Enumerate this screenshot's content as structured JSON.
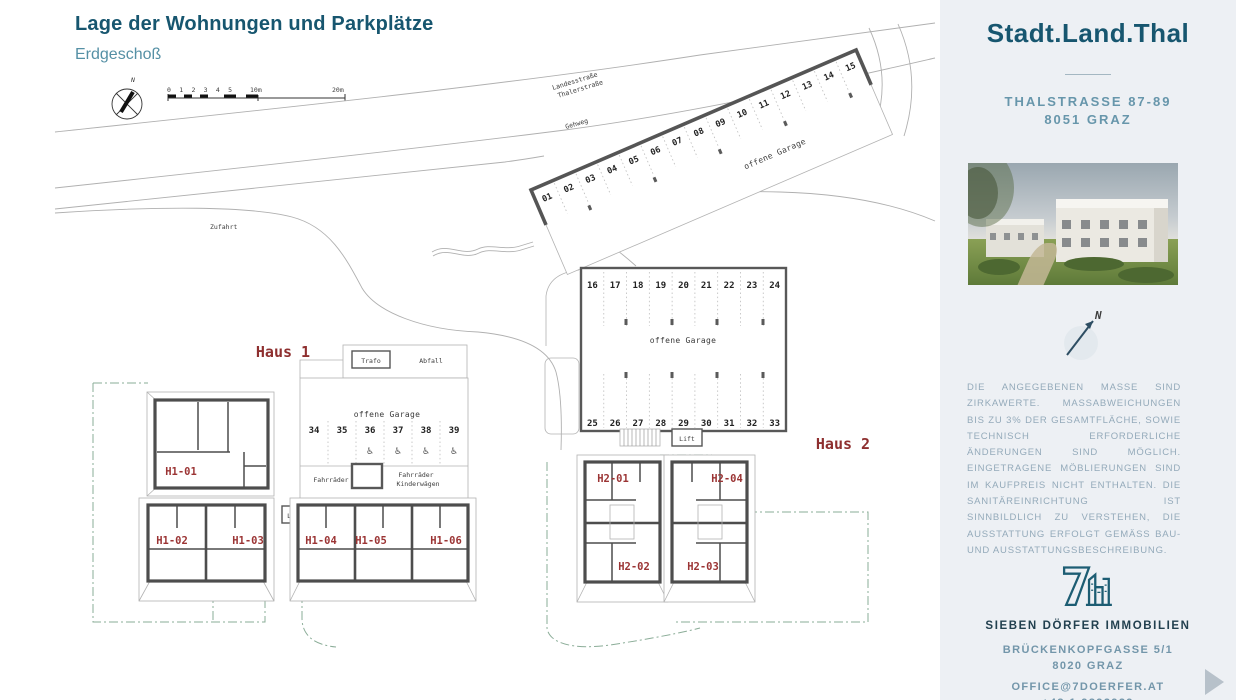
{
  "header": {
    "title": "Lage der Wohnungen und Parkplätze",
    "subtitle": "Erdgeschoß"
  },
  "plan": {
    "north": "N",
    "scale_ticks": "0 1 2 3 4 5",
    "scale_mid": "10m",
    "scale_end": "20m",
    "street_line1": "Landesstraße",
    "street_line2": "Thalerstraße",
    "sidewalk": "Gehweg",
    "access": "Zufahrt",
    "open_garage": "offene Garage",
    "haus1": "Haus 1",
    "haus2": "Haus 2",
    "trafo": "Trafo",
    "abfall": "Abfall",
    "bikes": "Fahrräder",
    "strollers": "Kinderwägen",
    "lift": "Lift",
    "parking_g1": [
      "01",
      "02",
      "03",
      "04",
      "05",
      "06",
      "07",
      "08",
      "09",
      "10",
      "11",
      "12",
      "13",
      "14",
      "15"
    ],
    "parking_g2_top": [
      "16",
      "17",
      "18",
      "19",
      "20",
      "21",
      "22",
      "23",
      "24"
    ],
    "parking_g2_bottom": [
      "25",
      "26",
      "27",
      "28",
      "29",
      "30",
      "31",
      "32",
      "33"
    ],
    "parking_g3": [
      "34",
      "35",
      "36",
      "37",
      "38",
      "39"
    ],
    "accessible_icons": [
      "♿",
      "♿",
      "♿",
      "♿"
    ],
    "units_h1": [
      "H1-01",
      "H1-02",
      "H1-03",
      "H1-04",
      "H1-05",
      "H1-06"
    ],
    "units_h2": [
      "H2-01",
      "H2-02",
      "H2-03",
      "H2-04"
    ]
  },
  "sidebar": {
    "brand": "Stadt.Land.Thal",
    "address_line1": "THALSTRASSE 87-89",
    "address_line2": "8051 GRAZ",
    "compass": "N",
    "disclaimer": "DIE ANGEGEBENEN MASSE SIND ZIRKAWERTE. MASSABWEICHUNGEN BIS ZU 3% DER GESAMTFLÄCHE, SOWIE TECHNISCH ERFORDERLICHE ÄNDERUNGEN SIND MÖGLICH. EINGETRAGENE MÖBLIERUNGEN SIND IM KAUFPREIS NICHT ENTHALTEN. DIE SANITÄREINRICHTUNG IST SINNBILDLICH ZU VERSTEHEN, DIE AUSSTATTUNG ERFOLGT GEMÄSS BAU- UND AUSSTATTUNGSBESCHREIBUNG.",
    "realtor": "SIEBEN DÖRFER IMMOBILIEN",
    "realtor_address1": "BRÜCKENKOPFGASSE 5/1",
    "realtor_address2": "8020 GRAZ",
    "email": "OFFICE@7DOERFER.AT",
    "phone": "+43 1 9392929"
  },
  "colors": {
    "accent": "#17566f",
    "accent_light": "#5590a5",
    "unit_label": "#8e2f2f",
    "boundary_green": "#8aac97",
    "sidebar_bg": "#edf0f4"
  }
}
